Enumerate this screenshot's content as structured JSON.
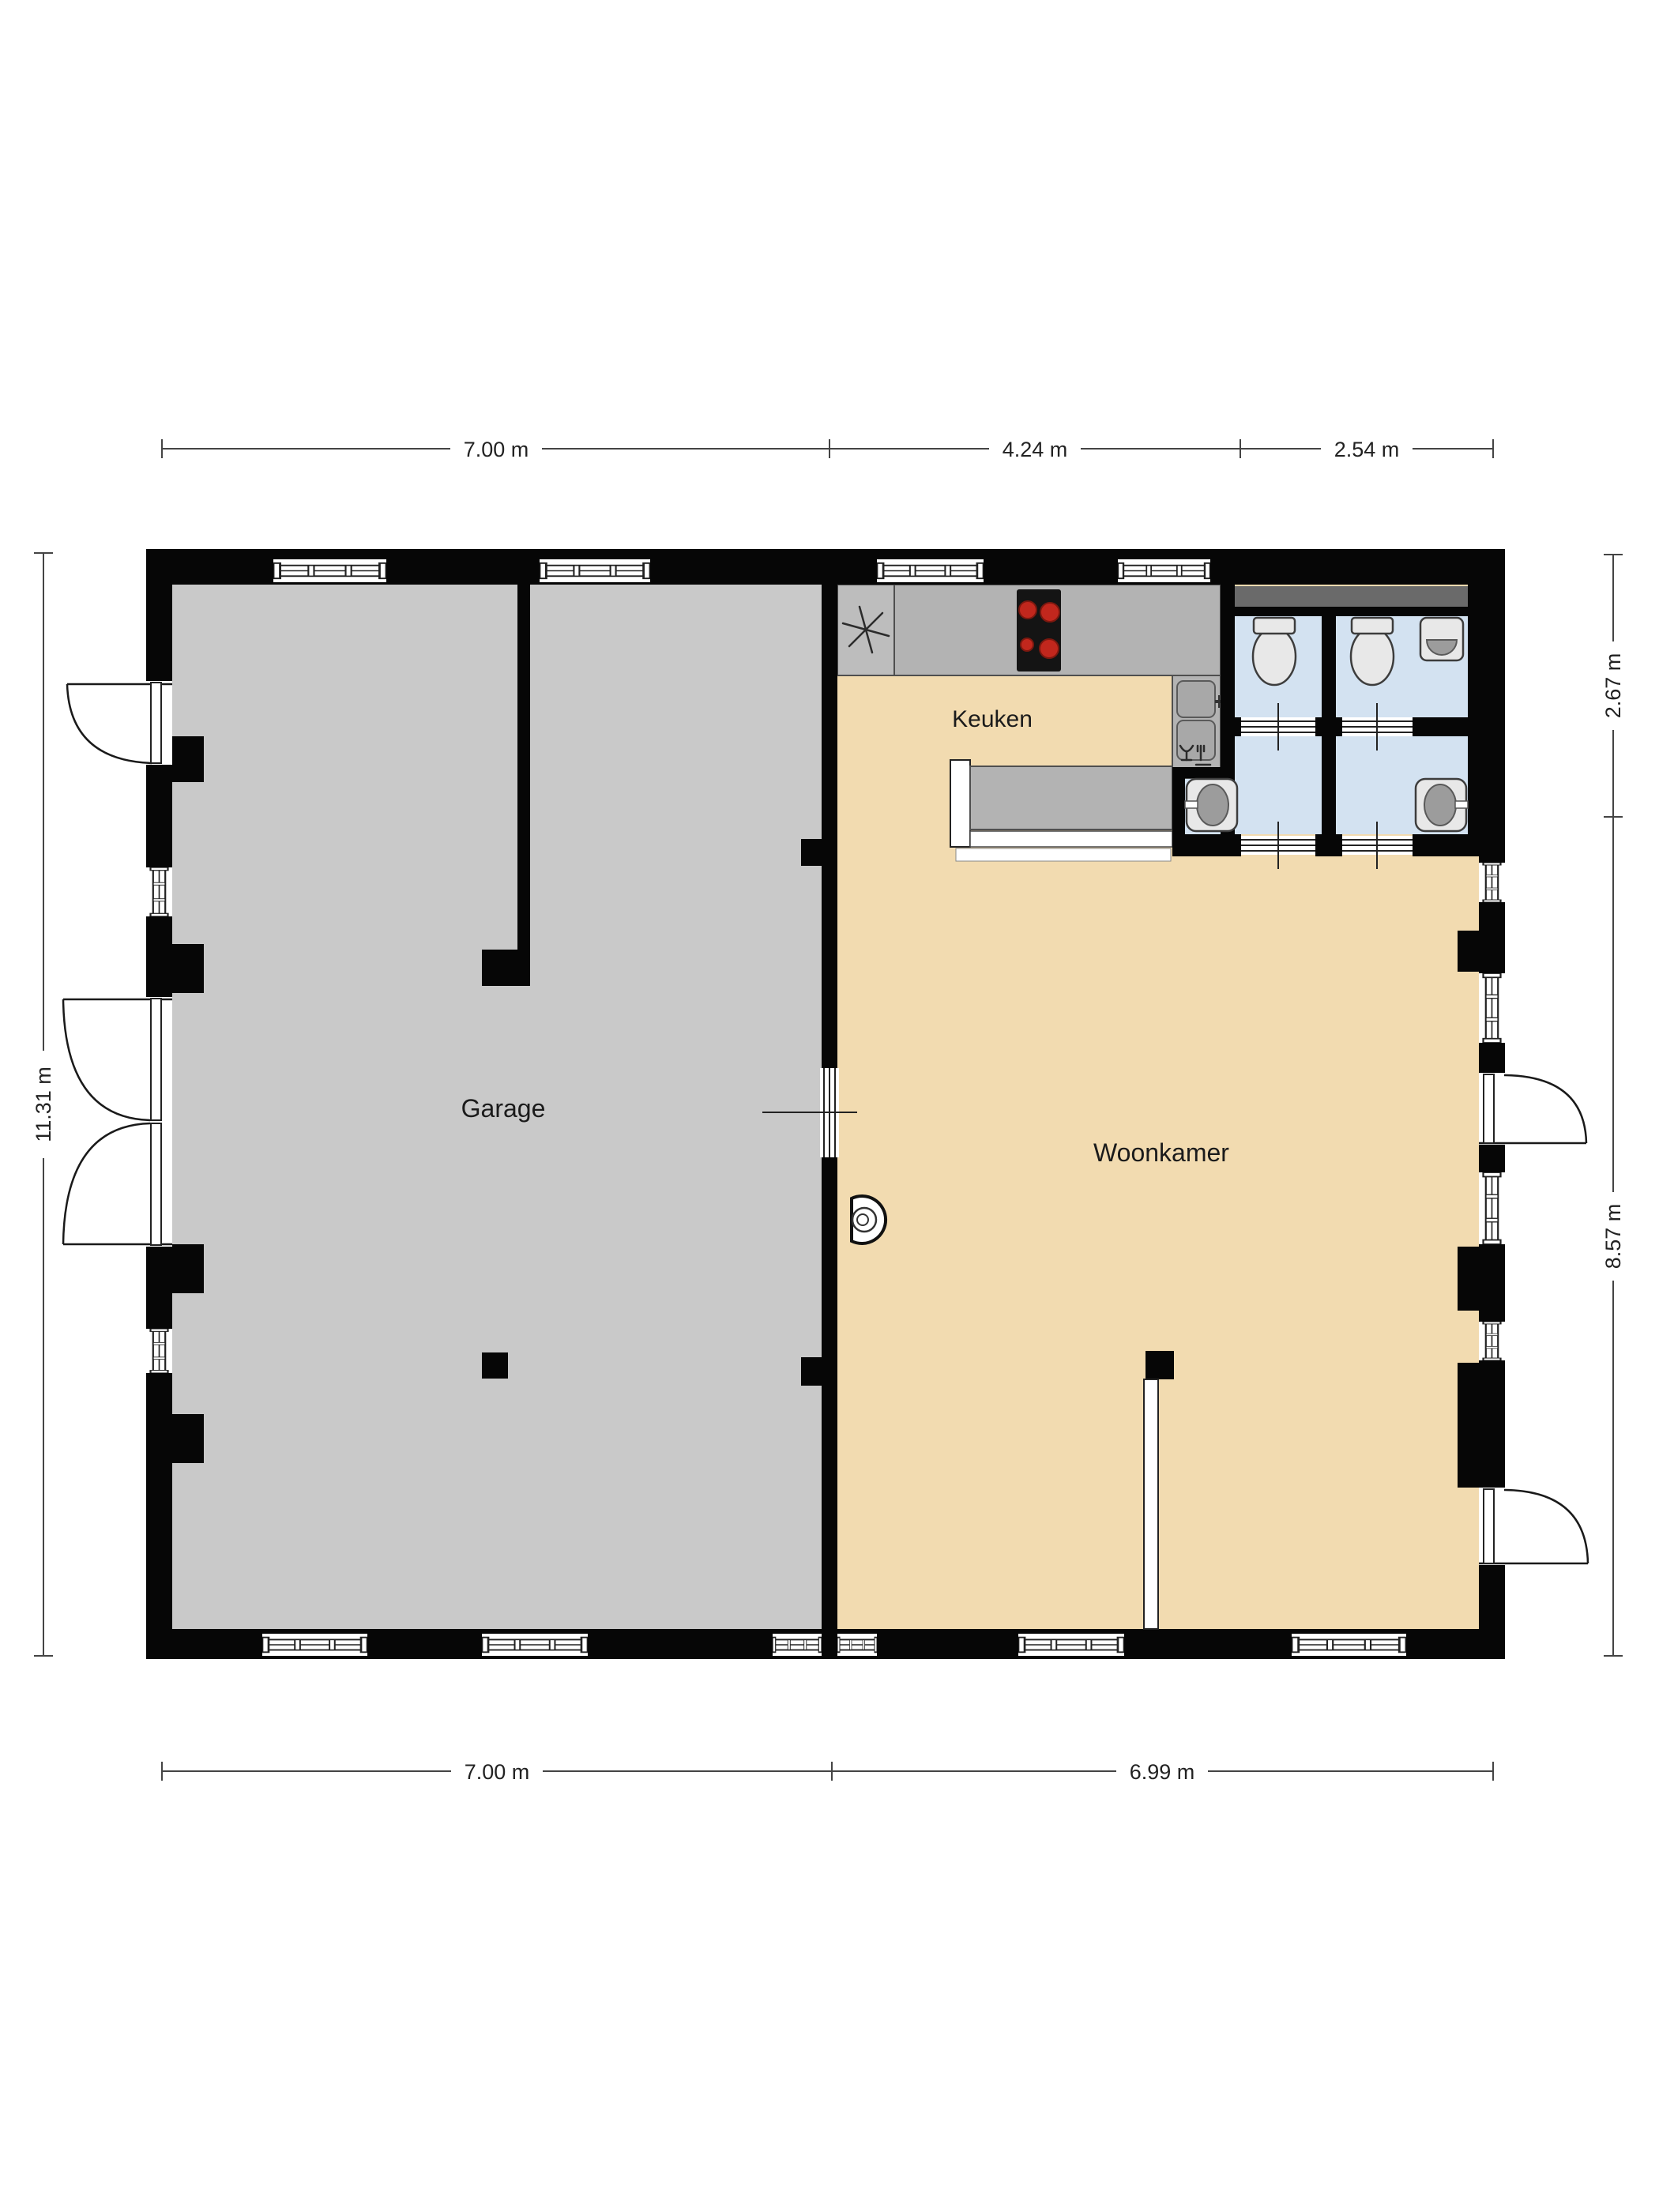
{
  "page": {
    "type": "2D floor plan drawing",
    "background": "#ffffff"
  },
  "rooms": {
    "garage": {
      "label": "Garage"
    },
    "keuken": {
      "label": "Keuken"
    },
    "woonkamer": {
      "label": "Woonkamer"
    }
  },
  "dimensions": {
    "top": [
      {
        "label": "7.00 m"
      },
      {
        "label": "4.24 m"
      },
      {
        "label": "2.54 m"
      }
    ],
    "bottom": [
      {
        "label": "7.00 m"
      },
      {
        "label": "6.99 m"
      }
    ],
    "left": [
      {
        "label": "11.31 m"
      }
    ],
    "right": [
      {
        "label": "2.67 m"
      },
      {
        "label": "8.57 m"
      }
    ]
  },
  "icons": {
    "extractor": "extractor-fan-icon",
    "hob": "cooktop-icon",
    "kitchen_sink": "kitchen-sink-icon",
    "dishwasher": "dishwasher-icon",
    "toilet_left": "toilet-icon",
    "toilet_right": "toilet-icon",
    "corner_basin": "corner-washbasin-icon",
    "washbasin_left": "washbasin-icon",
    "washbasin_right": "washbasin-icon",
    "wood_stove": "wood-stove-icon",
    "bar_counter": "bar-counter",
    "sliding_doors": "sliding-door-symbol",
    "swing_doors": "swing-door-symbol",
    "windows": "window-symbol"
  },
  "colors": {
    "wall": "#060606",
    "garage_floor": "#c9c9c9",
    "living_floor": "#f2dbb0",
    "bath_floor": "#d3e2f1",
    "counter": "#b3b3b3",
    "counter_dark": "#6a6a6a",
    "hob": "#141414",
    "burner": "#c1271d",
    "fixture": "#e8e8e8",
    "dim_text": "#222222"
  }
}
